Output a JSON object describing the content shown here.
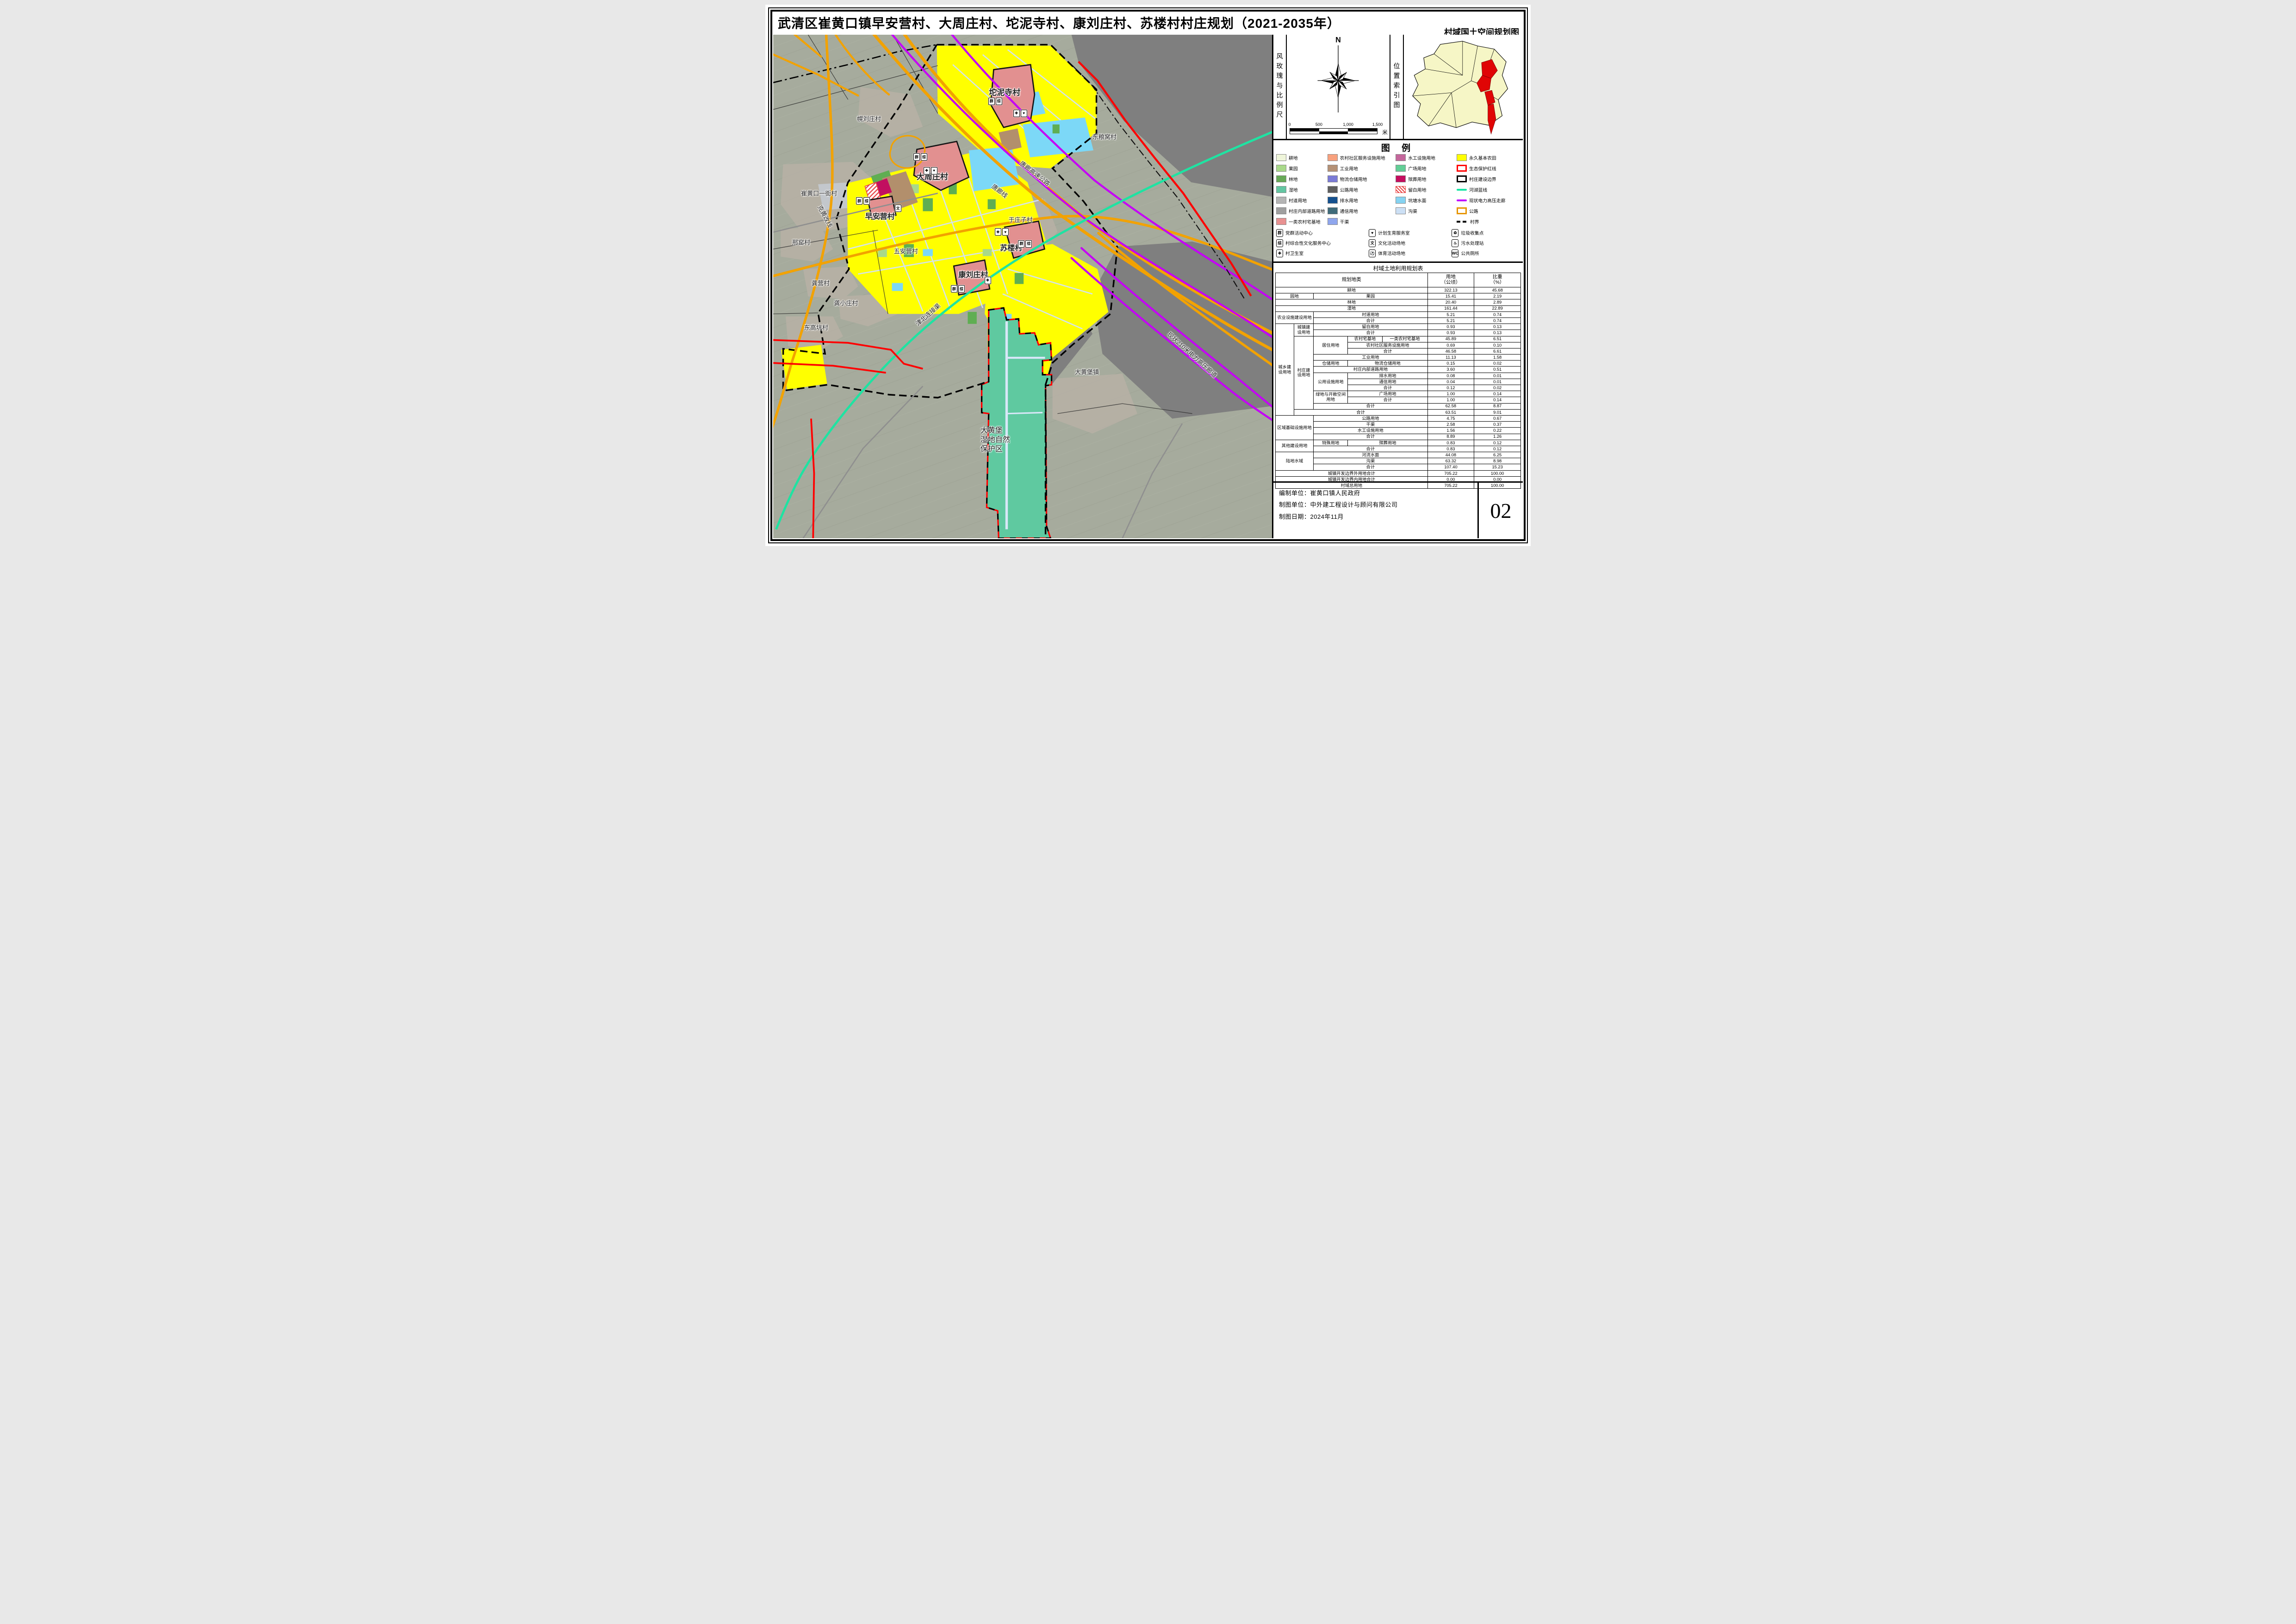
{
  "title": "武清区崔黄口镇早安营村、大周庄村、坨泥寺村、康刘庄村、苏楼村村庄规划（2021-2035年）",
  "subtitle": "村域国土空间规划图",
  "panel": {
    "compass_label": "风玫瑰与比例尺",
    "index_label": "位置索引图",
    "north": "N",
    "scale": {
      "ticks": [
        "0",
        "500",
        "1,000",
        "1,500"
      ],
      "unit": "米"
    }
  },
  "legend": {
    "title": "图 例",
    "cols": [
      [
        {
          "label": "耕地",
          "kind": "fill",
          "color": "#EFF5DA"
        },
        {
          "label": "果园",
          "kind": "fill",
          "color": "#A9D98A"
        },
        {
          "label": "林地",
          "kind": "fill",
          "color": "#67A957"
        },
        {
          "label": "湿地",
          "kind": "fill",
          "color": "#63C6A2"
        },
        {
          "label": "村道用地",
          "kind": "fill",
          "color": "#B5B5B5"
        },
        {
          "label": "村庄内部道路用地",
          "kind": "fill",
          "color": "#9F9F9F"
        },
        {
          "label": "一类农村宅基地",
          "kind": "fill",
          "color": "#E89191"
        }
      ],
      [
        {
          "label": "农村社区服务设施用地",
          "kind": "fill",
          "color": "#F8A17E"
        },
        {
          "label": "工业用地",
          "kind": "fill",
          "color": "#B59176"
        },
        {
          "label": "物流仓储用地",
          "kind": "fill",
          "color": "#7B7BD6"
        },
        {
          "label": "公路用地",
          "kind": "fill",
          "color": "#5F5F5F"
        },
        {
          "label": "排水用地",
          "kind": "fill",
          "color": "#15518F"
        },
        {
          "label": "通信用地",
          "kind": "fill",
          "color": "#3F6B7A"
        },
        {
          "label": "干渠",
          "kind": "fill",
          "color": "#8FA6ED"
        }
      ],
      [
        {
          "label": "水工设施用地",
          "kind": "fill",
          "color": "#C4679C"
        },
        {
          "label": "广场用地",
          "kind": "fill",
          "color": "#62CE96"
        },
        {
          "label": "殡葬用地",
          "kind": "fill",
          "color": "#C50E5F"
        },
        {
          "label": "留白用地",
          "kind": "hatch",
          "color": "#E84545"
        },
        {
          "label": "坑塘水面",
          "kind": "fill",
          "color": "#85D3F2"
        },
        {
          "label": "沟渠",
          "kind": "fill",
          "color": "#CCE0F5"
        },
        {
          "label": "",
          "kind": "none",
          "color": ""
        }
      ],
      [
        {
          "label": "永久基本农田",
          "kind": "fill",
          "color": "#FFFF00"
        },
        {
          "label": "生态保护红线",
          "kind": "outline",
          "color": "#FF0000"
        },
        {
          "label": "村庄建设边界",
          "kind": "outline",
          "color": "#000000"
        },
        {
          "label": "河湖蓝线",
          "kind": "line",
          "color": "#17E5A5"
        },
        {
          "label": "现状电力高压走廊",
          "kind": "line",
          "color": "#BF00FF"
        },
        {
          "label": "公路",
          "kind": "outline",
          "color": "#E69500"
        },
        {
          "label": "村界",
          "kind": "dash",
          "color": "#000000"
        }
      ]
    ],
    "facilities": [
      {
        "g": "群",
        "label": "党群活动中心"
      },
      {
        "g": "♥",
        "label": "计划生育服务室"
      },
      {
        "g": "♻",
        "label": "垃圾收集点"
      },
      {
        "g": "综",
        "label": "村综合性文化服务中心"
      },
      {
        "g": "文",
        "label": "文化活动场地"
      },
      {
        "g": "♨",
        "label": "污水处理站"
      },
      {
        "g": "✚",
        "label": "村卫生室"
      },
      {
        "g": "⚽",
        "label": "体育活动场地"
      },
      {
        "g": "WC",
        "label": "公共厕所"
      }
    ]
  },
  "table": {
    "title": "村域土地利用规划表",
    "rows": [
      [
        {
          "t": "规划地类",
          "c": 5,
          "h": 1
        },
        {
          "t": "用地\n（公顷）",
          "h": 1
        },
        {
          "t": "比重\n（%）",
          "h": 1
        }
      ],
      [
        {
          "t": "耕地",
          "c": 5
        },
        {
          "t": "322.13"
        },
        {
          "t": "45.68"
        }
      ],
      [
        {
          "t": "园地",
          "c": 2
        },
        {
          "t": "果园",
          "c": 3
        },
        {
          "t": "15.41"
        },
        {
          "t": "2.19"
        }
      ],
      [
        {
          "t": "林地",
          "c": 5
        },
        {
          "t": "20.40"
        },
        {
          "t": "2.89"
        }
      ],
      [
        {
          "t": "湿地",
          "c": 5
        },
        {
          "t": "161.44"
        },
        {
          "t": "22.89"
        }
      ],
      [
        {
          "t": "农业设施建设用地",
          "c": 2,
          "r": 2
        },
        {
          "t": "村道用地",
          "c": 3
        },
        {
          "t": "5.21"
        },
        {
          "t": "0.74"
        }
      ],
      [
        {
          "t": "合计",
          "c": 3
        },
        {
          "t": "5.21"
        },
        {
          "t": "0.74"
        }
      ],
      [
        {
          "t": "城乡建\n设用地",
          "r": 15
        },
        {
          "t": "城镇建\n设用地",
          "r": 2
        },
        {
          "t": "留白用地",
          "c": 3
        },
        {
          "t": "0.93"
        },
        {
          "t": "0.13"
        }
      ],
      [
        {
          "t": "合计",
          "c": 3
        },
        {
          "t": "0.93"
        },
        {
          "t": "0.13"
        }
      ],
      [
        {
          "t": "村庄建\n设用地",
          "r": 12
        },
        {
          "t": "居住用地",
          "r": 3
        },
        {
          "t": "农村宅基地"
        },
        {
          "t": "一类农村宅基地"
        },
        {
          "t": "45.89"
        },
        {
          "t": "6.51"
        }
      ],
      [
        {
          "t": "农村社区服务设施用地",
          "c": 2
        },
        {
          "t": "0.69"
        },
        {
          "t": "0.10"
        }
      ],
      [
        {
          "t": "合计",
          "c": 2
        },
        {
          "t": "46.58"
        },
        {
          "t": "6.61"
        }
      ],
      [
        {
          "t": "工业用地",
          "c": 3
        },
        {
          "t": "11.13"
        },
        {
          "t": "1.58"
        }
      ],
      [
        {
          "t": "仓储用地"
        },
        {
          "t": "物流仓储用地",
          "c": 2
        },
        {
          "t": "0.15"
        },
        {
          "t": "0.02"
        }
      ],
      [
        {
          "t": "村庄内部道路用地",
          "c": 3
        },
        {
          "t": "3.60"
        },
        {
          "t": "0.51"
        }
      ],
      [
        {
          "t": "公用设施用地",
          "r": 3
        },
        {
          "t": "排水用地",
          "c": 2
        },
        {
          "t": "0.08"
        },
        {
          "t": "0.01"
        }
      ],
      [
        {
          "t": "通信用地",
          "c": 2
        },
        {
          "t": "0.04"
        },
        {
          "t": "0.01"
        }
      ],
      [
        {
          "t": "合计",
          "c": 2
        },
        {
          "t": "0.12"
        },
        {
          "t": "0.02"
        }
      ],
      [
        {
          "t": "绿地与开敞空间用地",
          "r": 2
        },
        {
          "t": "广场用地",
          "c": 2
        },
        {
          "t": "1.00"
        },
        {
          "t": "0.14"
        }
      ],
      [
        {
          "t": "合计",
          "c": 2
        },
        {
          "t": "1.00"
        },
        {
          "t": "0.14"
        }
      ],
      [
        {
          "t": "合计",
          "c": 3
        },
        {
          "t": "62.58"
        },
        {
          "t": "8.87"
        }
      ],
      [
        {
          "t": "合计",
          "c": 4
        },
        {
          "t": "63.51"
        },
        {
          "t": "9.01"
        }
      ],
      [
        {
          "t": "区域基础设施用地",
          "c": 2,
          "r": 4
        },
        {
          "t": "公路用地",
          "c": 3
        },
        {
          "t": "4.75"
        },
        {
          "t": "0.67"
        }
      ],
      [
        {
          "t": "干渠",
          "c": 3
        },
        {
          "t": "2.58"
        },
        {
          "t": "0.37"
        }
      ],
      [
        {
          "t": "水工设施用地",
          "c": 3
        },
        {
          "t": "1.56"
        },
        {
          "t": "0.22"
        }
      ],
      [
        {
          "t": "合计",
          "c": 3
        },
        {
          "t": "8.89"
        },
        {
          "t": "1.26"
        }
      ],
      [
        {
          "t": "其他建设用地",
          "c": 2,
          "r": 2
        },
        {
          "t": "特殊用地"
        },
        {
          "t": "殡葬用地",
          "c": 2
        },
        {
          "t": "0.83"
        },
        {
          "t": "0.12"
        }
      ],
      [
        {
          "t": "合计",
          "c": 3
        },
        {
          "t": "0.83"
        },
        {
          "t": "0.12"
        }
      ],
      [
        {
          "t": "陆地水域",
          "c": 2,
          "r": 3
        },
        {
          "t": "河流水面",
          "c": 3
        },
        {
          "t": "44.08"
        },
        {
          "t": "6.25"
        }
      ],
      [
        {
          "t": "沟渠",
          "c": 3
        },
        {
          "t": "63.32"
        },
        {
          "t": "8.98"
        }
      ],
      [
        {
          "t": "合计",
          "c": 3
        },
        {
          "t": "107.40"
        },
        {
          "t": "15.23"
        }
      ],
      [
        {
          "t": "城镇开发边界外用地合计",
          "c": 5
        },
        {
          "t": "705.22"
        },
        {
          "t": "100.00"
        }
      ],
      [
        {
          "t": "城镇开发边界内用地合计",
          "c": 5
        },
        {
          "t": "0.00"
        },
        {
          "t": "0.00"
        }
      ],
      [
        {
          "t": "村域总用地",
          "c": 5
        },
        {
          "t": "705.22"
        },
        {
          "t": "100.00"
        }
      ]
    ]
  },
  "footer": {
    "lines": [
      "编制单位：崔黄口镇人民政府",
      "制图单位：中外建工程设计与顾问有限公司",
      "制图日期：2024年11月"
    ],
    "page": "02"
  },
  "map": {
    "colors": {
      "permanent_farmland": "#FFFF00",
      "wetland": "#5FC9A0",
      "residential_pink": "#E29090",
      "pond_blue": "#7CD8F7",
      "road_orange": "#F2A200",
      "power_purple": "#C400F6",
      "river_teal": "#1FE3A2",
      "eco_red": "#FF0000",
      "mask_gray": "#7F7F7F"
    },
    "labels": [
      {
        "t": "幌刘庄村",
        "x": 19.2,
        "y": 16.6
      },
      {
        "t": "东粮窝村",
        "x": 66.4,
        "y": 20.2
      },
      {
        "t": "坨泥寺村",
        "x": 46.4,
        "y": 11.3,
        "s": 17,
        "b": 1
      },
      {
        "t": "大周庄村",
        "x": 31.9,
        "y": 28.0,
        "s": 17,
        "b": 1
      },
      {
        "t": "崔黄口一街村",
        "x": 9.2,
        "y": 31.4
      },
      {
        "t": "早安营村",
        "x": 21.4,
        "y": 35.9,
        "s": 16,
        "b": 1
      },
      {
        "t": "邢窑村",
        "x": 5.6,
        "y": 41.2
      },
      {
        "t": "于庄子村",
        "x": 49.6,
        "y": 36.7
      },
      {
        "t": "五安营村",
        "x": 26.6,
        "y": 42.9
      },
      {
        "t": "苏楼村",
        "x": 47.7,
        "y": 42.2,
        "s": 16,
        "b": 1
      },
      {
        "t": "康刘庄村",
        "x": 40.1,
        "y": 47.5,
        "s": 16,
        "b": 1
      },
      {
        "t": "龚营村",
        "x": 9.5,
        "y": 49.3
      },
      {
        "t": "龚小庄村",
        "x": 14.6,
        "y": 53.2
      },
      {
        "t": "东高坑村",
        "x": 8.6,
        "y": 58.1
      },
      {
        "t": "大黄堡镇",
        "x": 62.9,
        "y": 66.9
      },
      {
        "t": "大黄堡\n湿地自然\n保护区",
        "x": 44.5,
        "y": 80.5,
        "s": 16,
        "ml": 1
      },
      {
        "t": "克黄改线",
        "x": 10.5,
        "y": 36.0,
        "r": 62
      },
      {
        "t": "津北连接渠",
        "x": 31.0,
        "y": 55.5,
        "r": -41
      },
      {
        "t": "唐廊高速公路",
        "x": 52.5,
        "y": 27.5,
        "r": 38
      },
      {
        "t": "唐廊线",
        "x": 45.5,
        "y": 31.0,
        "r": 38
      },
      {
        "t": "现状210米电力高压廊道",
        "x": 84.0,
        "y": 63.5,
        "r": 42
      }
    ],
    "facility_chips": [
      {
        "x": 44.5,
        "y": 13.2,
        "g": "群综"
      },
      {
        "x": 49.5,
        "y": 15.6,
        "g": "✚♥"
      },
      {
        "x": 29.5,
        "y": 24.3,
        "g": "群综"
      },
      {
        "x": 31.5,
        "y": 27.0,
        "g": "✚♥"
      },
      {
        "x": 18.0,
        "y": 33.0,
        "g": "群综"
      },
      {
        "x": 25.0,
        "y": 34.5,
        "g": "文"
      },
      {
        "x": 45.8,
        "y": 39.2,
        "g": "✚♥"
      },
      {
        "x": 50.5,
        "y": 41.5,
        "g": "群综"
      },
      {
        "x": 37.0,
        "y": 50.5,
        "g": "群综"
      },
      {
        "x": 43.0,
        "y": 48.8,
        "g": "✚"
      }
    ]
  }
}
